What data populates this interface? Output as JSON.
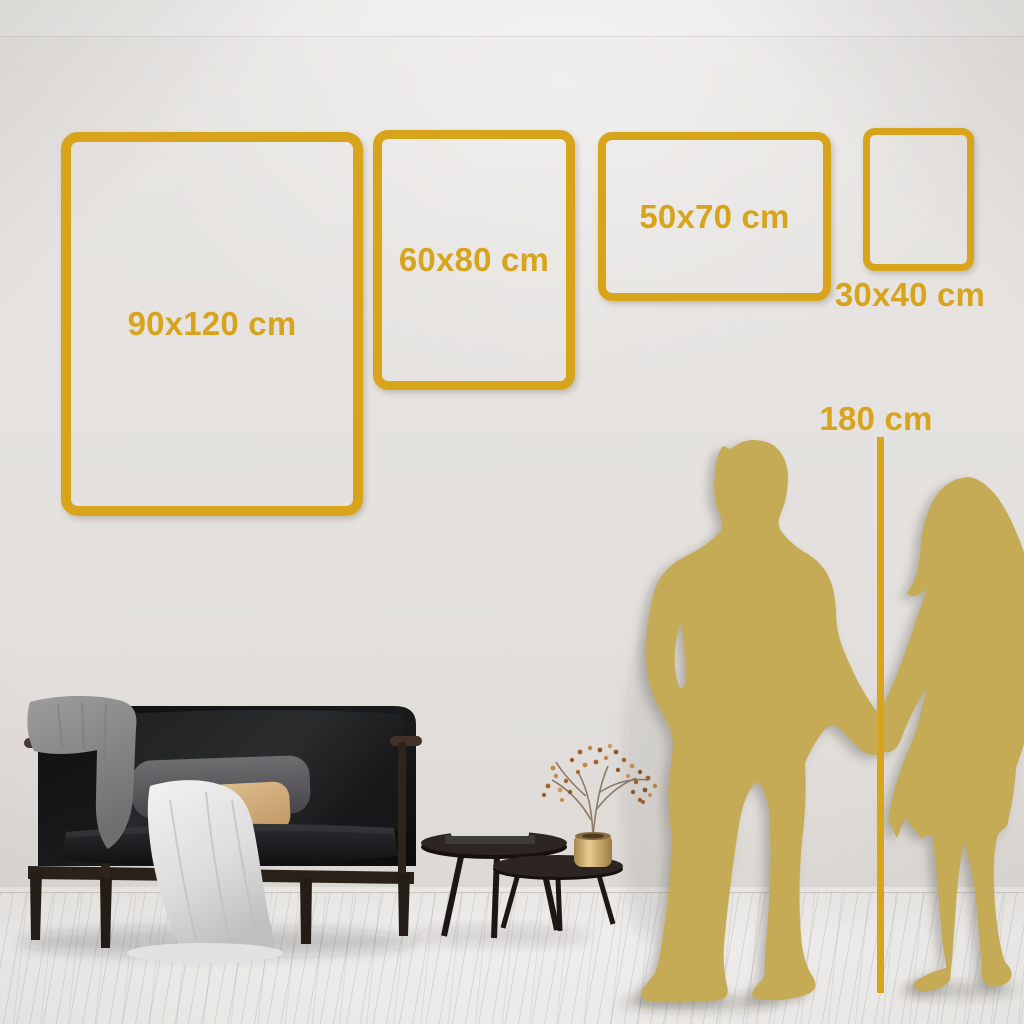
{
  "frames": [
    {
      "id": "frame-90x120",
      "label": "90x120 cm",
      "label_position": "inside"
    },
    {
      "id": "frame-60x80",
      "label": "60x80 cm",
      "label_position": "inside"
    },
    {
      "id": "frame-50x70",
      "label": "50x70 cm",
      "label_position": "inside"
    },
    {
      "id": "frame-30x40",
      "label": "30x40 cm",
      "label_position": "below"
    }
  ],
  "height_reference": {
    "label": "180 cm"
  },
  "colors": {
    "frame_gold": "#D7A41C",
    "silhouette_gold": "#C6AB57",
    "wall": "#E4E1DE",
    "floor": "#F4F3F1"
  },
  "scene_objects": {
    "couple": "man-and-woman-silhouette-holding-hands",
    "furniture": [
      "black-sofa",
      "grey-blanket",
      "white-throw",
      "tan-pillow",
      "nesting-coffee-tables",
      "books",
      "gold-vase",
      "dried-branch"
    ]
  }
}
